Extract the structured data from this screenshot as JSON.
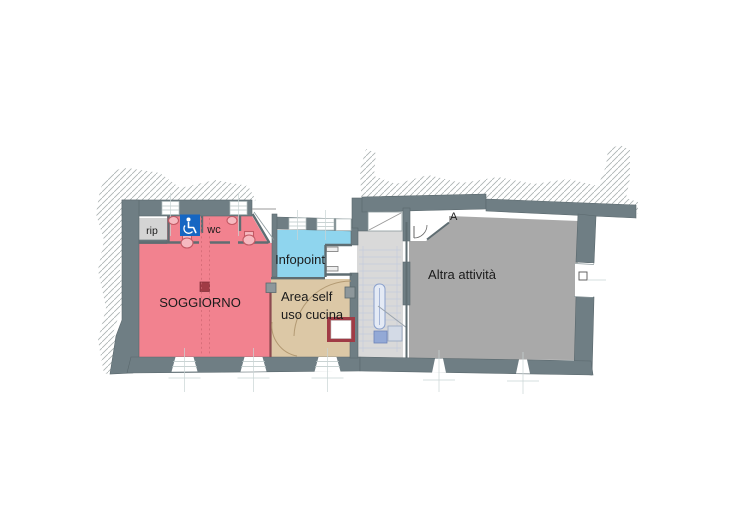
{
  "plan": {
    "title": "floor-plan",
    "labels": {
      "soggiorno": "SOGGIORNO",
      "rip": "rip",
      "wc": "wc",
      "infopoint": "Infopoint",
      "area_self_line1": "Area self",
      "area_self_line2": "uso cucina",
      "altra": "Altra attività",
      "entrance": "A"
    },
    "colors": {
      "wall": "#6f7e84",
      "wall_edge": "#5a686d",
      "soggiorno": "#f2828f",
      "infopoint": "#8fd5ee",
      "kitchen": "#dcc8a6",
      "altra": "#a9a9a9",
      "stair_hall": "#d9d9d9",
      "rip": "#d4d4d4",
      "accent_red": "#a03b45",
      "accessible_blue": "#1666c2",
      "fixture": "#c25964",
      "stair_blue": "#8aa0cc"
    },
    "icons": {
      "accessible_wc": "wheelchair"
    }
  }
}
